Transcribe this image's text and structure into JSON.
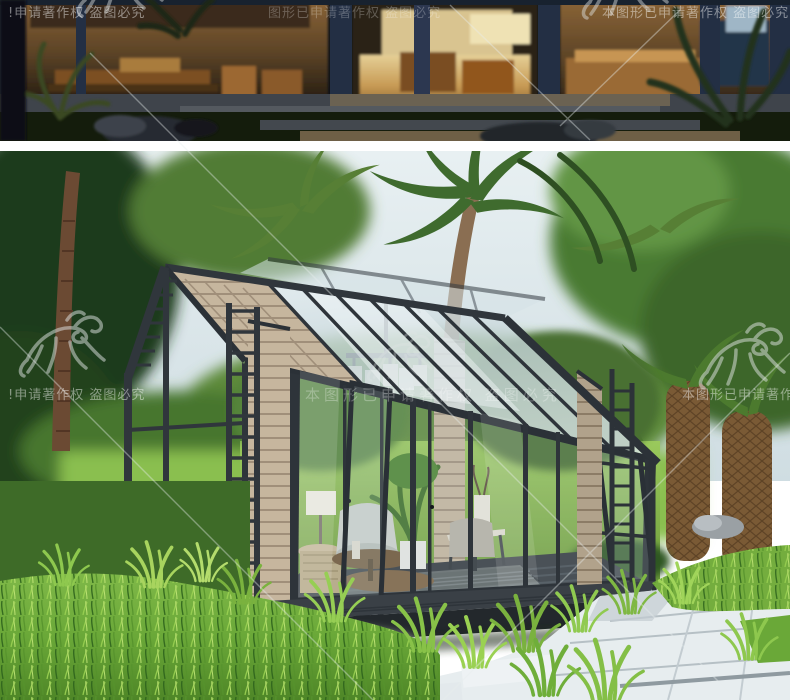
{
  "image": {
    "kind": "product-detail-renders",
    "subject": "aluminum-frame glass sunroom / garden house",
    "panels": [
      {
        "id": "night-photo",
        "label": "night exterior view of lit sunroom lounge"
      },
      {
        "id": "day-render",
        "label": "daytime render of gabled glass sunroom with wood panel walls in tropical garden"
      }
    ]
  },
  "watermark": {
    "full_text": "本图形已申请著作权 盗图必究",
    "rows": {
      "top": {
        "left": "!申请著作权 盗图必究",
        "center": "图形已申请著作权 盗图必究",
        "right": "本图形已申请著作权 盗图必究"
      },
      "middle": {
        "left": "!申请著作权 盗图必究",
        "center": "本图形已申请著作权 盗图必究",
        "right": "本图形已申请著作权 盗图"
      }
    },
    "logo_name": "dragon-calligraphy-watermark",
    "text_color": "#ffffff",
    "text_opacity": 0.42
  },
  "palette": {
    "divider": "#ffffff",
    "night_bg": "#0d1118",
    "night_glow": "#c08748",
    "frame_dark": "#30363c",
    "frame_navy": "#26324a",
    "wood_panel": "#c6b69e",
    "wood_line": "#a08f7a",
    "glass_roof": "#d3e0e5",
    "sky": "#dbe6ea",
    "tree_dark": "#24421f",
    "tree_mid": "#41672f",
    "lawn_sunlit": "#8abf50",
    "grass_bright": "#7ab23e",
    "grass_light": "#a8d45e",
    "deck": "#2a2f34",
    "paver": "#e7edef",
    "paver_shade": "#c3ccd1"
  }
}
